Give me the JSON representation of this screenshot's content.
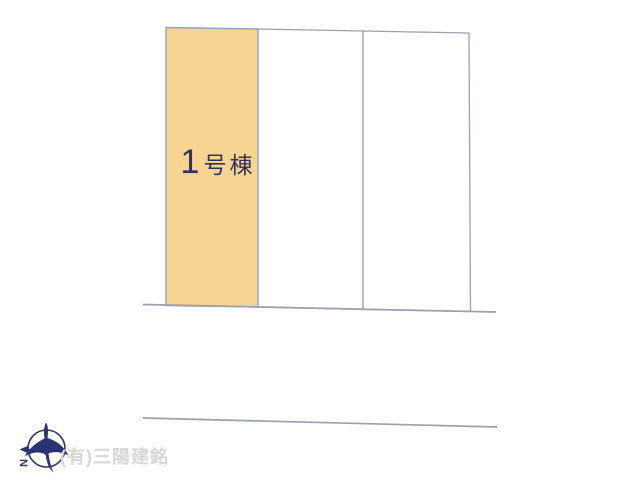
{
  "page": {
    "background": "#FFFFFF",
    "width_px": 640,
    "height_px": 480
  },
  "plan": {
    "lots": [
      {
        "id": "1",
        "label": "1号棟",
        "label_number": "1",
        "label_suffix": "号棟",
        "highlighted": true,
        "fill": "#F7D492"
      },
      {
        "id": "2",
        "highlighted": false,
        "fill": "#FFFFFF"
      },
      {
        "id": "3",
        "highlighted": false,
        "fill": "#FFFFFF"
      }
    ],
    "line_color": "#99A0B0",
    "label_color": "#32325A"
  },
  "compass": {
    "north_label": "N",
    "color": "#2A3474"
  },
  "footer": {
    "company": "(有)三陽建銘",
    "color": "#D7D7D7"
  }
}
